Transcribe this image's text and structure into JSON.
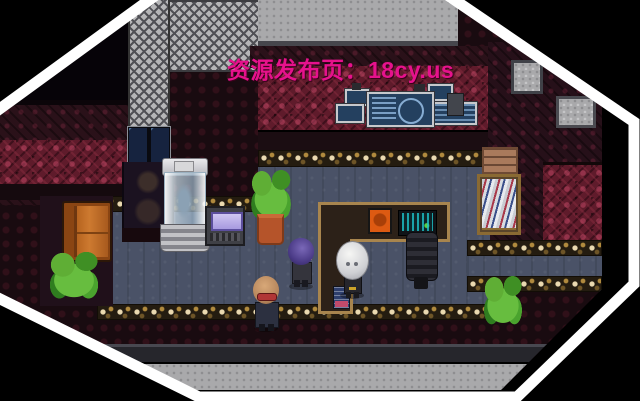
{
  "site_banner": {
    "text": "资源发布页：18cy.us",
    "color": "#e6128c"
  },
  "frame": {
    "shape": "octagon-vignette",
    "stripe_color": "#ffffff",
    "background": "#000000"
  },
  "scene": {
    "style": "pixel-rpg-interior",
    "characters": [
      {
        "name": "purple-hair-npc",
        "desc": "small NPC with round purple hair facing right"
      },
      {
        "name": "bald-npc",
        "desc": "bald NPC with red goggles walking downward"
      },
      {
        "name": "skull-head-npc",
        "desc": "NPC with oversized white skull head standing at the desk"
      }
    ],
    "objects": [
      "wall-monitor-cluster",
      "sliding-glass-doors",
      "glass-capsule",
      "console-machine",
      "potted-plant-tall",
      "floor-plant-left",
      "floor-plant-right",
      "leather-couch",
      "bookshelf",
      "wooden-crate",
      "l-shaped-desk",
      "orange-poster",
      "desktop-computer",
      "office-chair",
      "blue-placard",
      "wall-window",
      "wall-tile-patch"
    ],
    "palette": {
      "floor_slate": "#4a5267",
      "wall_red": "#5f1b2b",
      "wall_dark": "#2a1119",
      "carpet_gold": "#c9a86a",
      "desk_tan": "#a8854e",
      "screen_teal": "#1ec2c9",
      "screen_lavender": "#b4a8ea",
      "couch_orange": "#c0702a",
      "plant_green": "#4aa32e"
    }
  }
}
